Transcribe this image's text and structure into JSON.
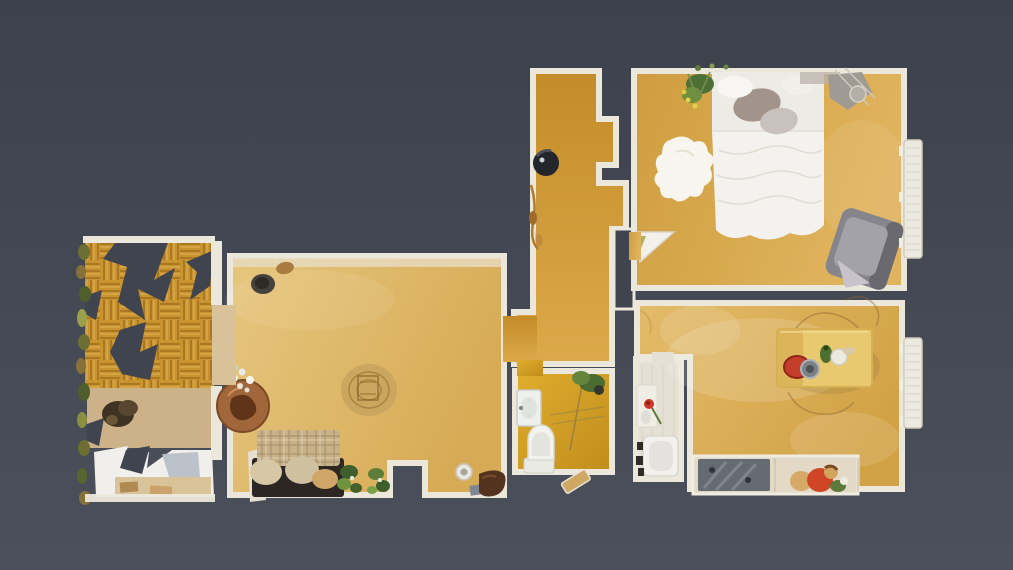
{
  "scene": {
    "type": "3d-scan-floorplan-top-down",
    "description": "Top-down dollhouse view of a photogrammetry-scanned apartment on a dark slate background. No text or UI chrome visible.",
    "rooms": [
      {
        "id": "balcony",
        "label": "Balcony",
        "floor": "herringbone parquet, partially unscanned with jagged holes",
        "items": [
          "railing plants",
          "dried shrub",
          "white table area",
          "deck band"
        ]
      },
      {
        "id": "living-room",
        "label": "Living room",
        "floor": "light oak planks",
        "items": [
          "sofa with plaid blanket",
          "three cushions",
          "leafy plant sprigs",
          "round side table",
          "white flowers",
          "jute rug",
          "dark planter",
          "wicker basket",
          "plate",
          "brown boot",
          "entrance recess"
        ]
      },
      {
        "id": "hallway",
        "label": "Hallway",
        "floor": "golden oak planks",
        "items": [
          "robot vacuum",
          "dried stalks",
          "open white door leaf"
        ]
      },
      {
        "id": "bathroom",
        "label": "Bathroom",
        "floor": "golden planks",
        "items": [
          "wash basin",
          "toilet",
          "shower glass",
          "green plant",
          "open tan door leaf"
        ]
      },
      {
        "id": "utility-room",
        "label": "Utility room",
        "floor": "pale tiles",
        "items": [
          "counter with red rose",
          "glass",
          "washing machine",
          "dark shelf items"
        ]
      },
      {
        "id": "bedroom",
        "label": "Bedroom",
        "floor": "oak planks",
        "items": [
          "double bed with white duvet",
          "grey pillows",
          "sheepskin rug",
          "flowering plant",
          "clothes rack with mirror",
          "grey armchair",
          "wall radiator",
          "open door leaf"
        ]
      },
      {
        "id": "kitchen-dining",
        "label": "Kitchen / dining room",
        "floor": "oak planks with scan haze",
        "items": [
          "wooden dining table",
          "red chair",
          "grey bowl",
          "green bottle",
          "white jar",
          "sketched chair outlines",
          "kitchen counter",
          "dark cooktop",
          "seated person in red",
          "wall radiator"
        ]
      }
    ]
  },
  "colors": {
    "background_top": "#3d414b",
    "background_bottom": "#4c505a",
    "background": "#40444e",
    "wall": "#ebe7db",
    "windowsill": "#e7d9bd",
    "living_floor_light": "#e6c67e",
    "living_floor_dark": "#d7ab56",
    "bedroom_floor_light": "#e0b45e",
    "bedroom_floor_dark": "#cf9d3f",
    "hall_floor_light": "#dca94a",
    "hall_floor_dark": "#c38c28",
    "bath_floor_light": "#e0ad2e",
    "bath_floor_dark": "#c08d1c",
    "dining_floor_light": "#e3bc6a",
    "dining_floor_dark": "#d2a246",
    "parquet_base": "#c9942f",
    "parquet_dark": "#9c6a1d",
    "parquet_light": "#e3b964",
    "deck": "#cdb289",
    "utility_floor": "#e5e0d4",
    "plank_line": "#a3751f",
    "bed_duvet": "#f3f2ee",
    "bed_sheet": "#edebe5",
    "pillow_dark": "#a2948b",
    "pillow_light": "#c9c2bc",
    "sheepskin": "#f7f5ee",
    "armchair": "#87858c",
    "armchair_light": "#a4a2a9",
    "armchair_dark": "#6b6970",
    "radiator": "#ece9e1",
    "radiator_line": "#cfcabc",
    "sofa_base": "#2c2722",
    "plaid": "#c7b28a",
    "plaid_line": "#977b53",
    "cushion": "#d8c7a5",
    "cushion_tan": "#d0a568",
    "plant_dark": "#46602b",
    "plant_mid": "#5d7d38",
    "plant_light": "#7da04b",
    "round_table": "#a1673a",
    "round_table_dark": "#5f3418",
    "rug_jute": "#c8a35e",
    "rug_line": "#93702f",
    "robot": "#23262b",
    "dining_table": "#e8c96f",
    "red_accent": "#c33d2a",
    "bowl_gray": "#7c8187",
    "bottle_green": "#4e6f2f",
    "counter": "#e2d9c7",
    "cooktop": "#656b72",
    "skin_tan": "#d2a35c",
    "shirt_red": "#cf4526",
    "toilet_white": "#f2f3ef",
    "white_patch": "#f0efec",
    "door_leaf": "#f2efe7",
    "door_tan": "#cfa963"
  }
}
